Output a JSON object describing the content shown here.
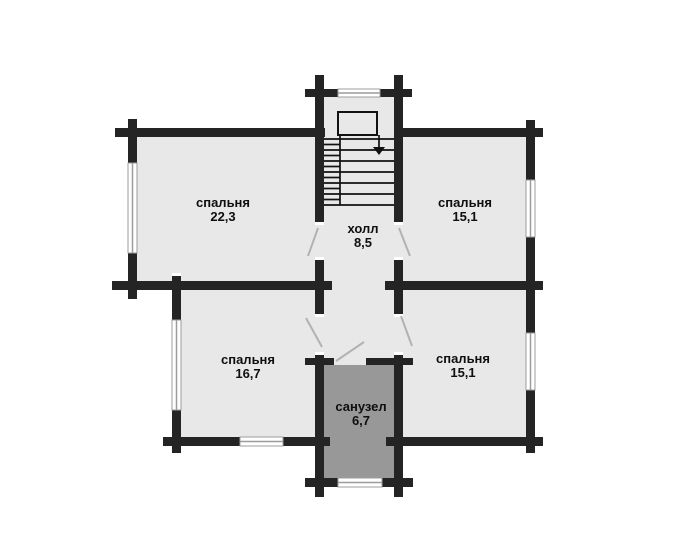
{
  "plan": {
    "title": "floor-plan-second-storey",
    "rooms": [
      {
        "id": "bedroom-top-left",
        "label": "спальня",
        "area": "22,3"
      },
      {
        "id": "bedroom-top-right",
        "label": "спальня",
        "area": "15,1"
      },
      {
        "id": "hall",
        "label": "холл",
        "area": "8,5"
      },
      {
        "id": "bedroom-bottom-left",
        "label": "спальня",
        "area": "16,7"
      },
      {
        "id": "bedroom-bottom-right",
        "label": "спальня",
        "area": "15,1"
      },
      {
        "id": "bathroom",
        "label": "санузел",
        "area": "6,7"
      }
    ],
    "colors": {
      "wall": "#242424",
      "room_fill": "#e8e8e8",
      "bathroom_fill": "#989898",
      "window_line": "#9c9c9c",
      "door_line": "#b2b2b2",
      "stair_line": "#111111",
      "text": "#0f0f0f",
      "background": "#ffffff"
    }
  }
}
